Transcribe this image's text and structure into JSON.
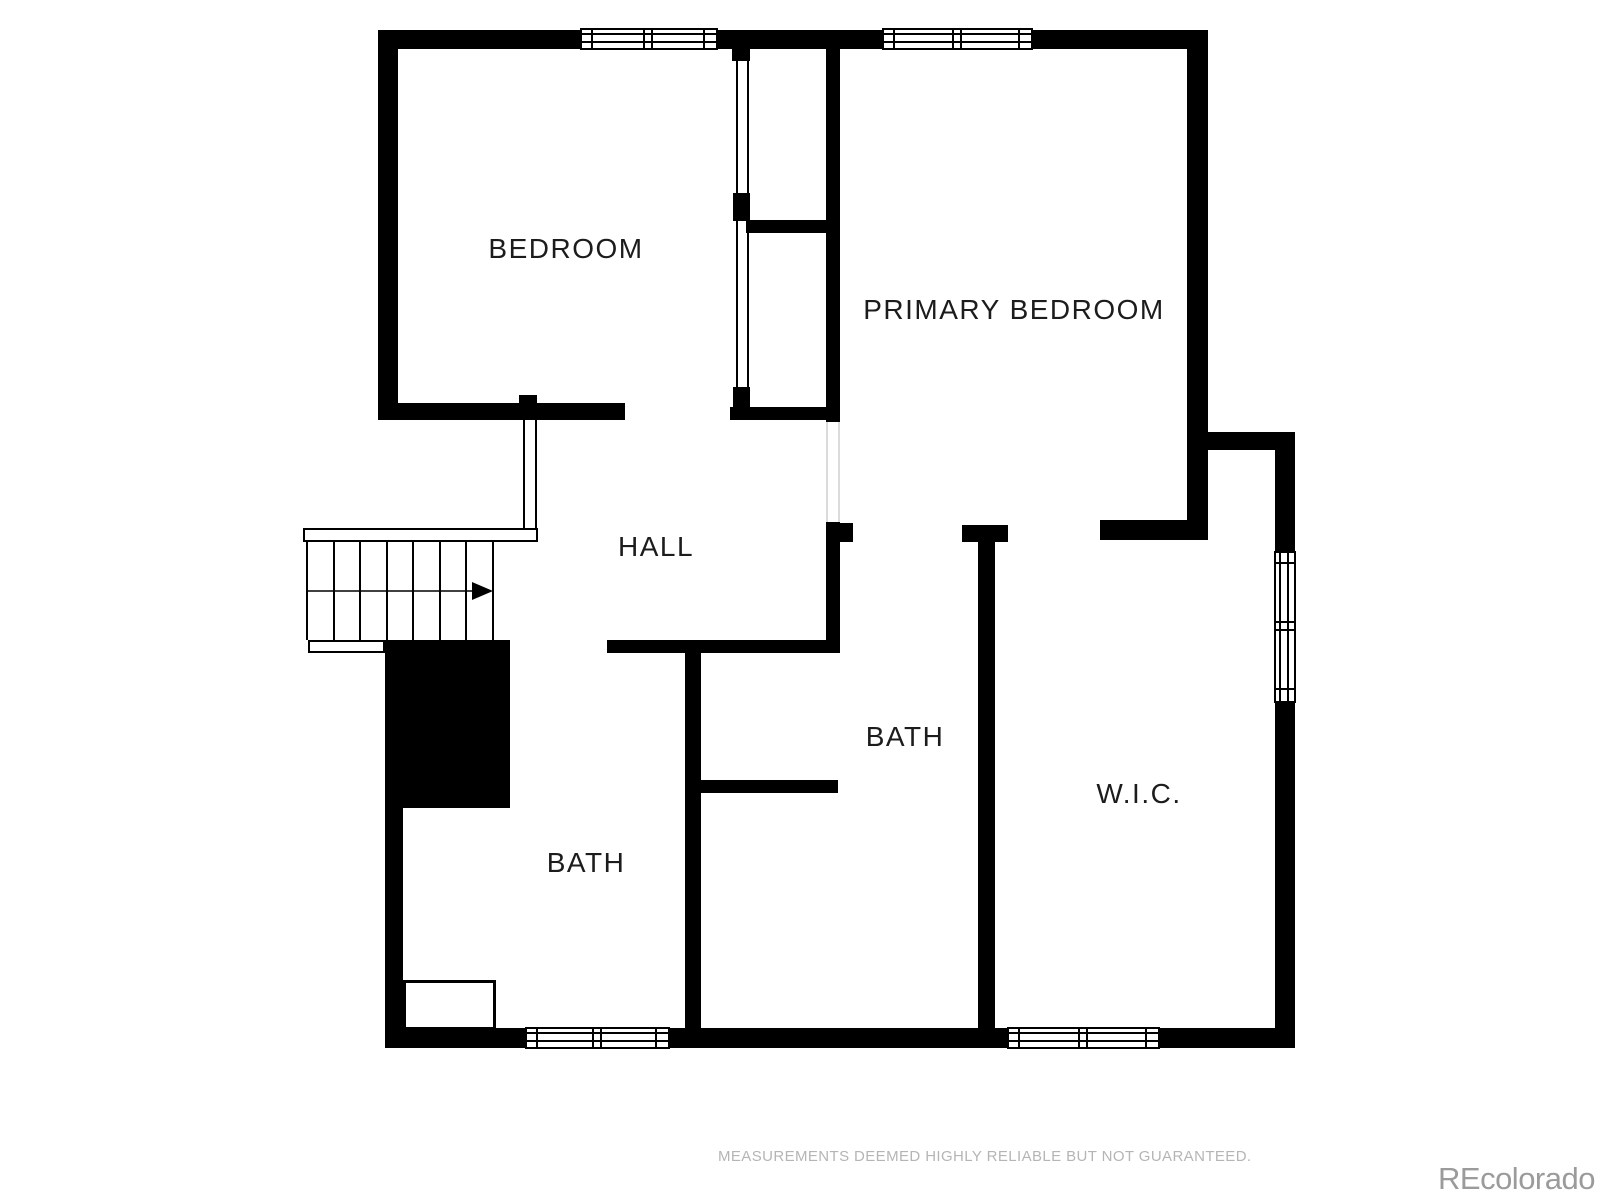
{
  "plan": {
    "type": "floor-plan",
    "rooms": [
      {
        "id": "bedroom",
        "label": "BEDROOM"
      },
      {
        "id": "primary-bedroom",
        "label": "PRIMARY BEDROOM"
      },
      {
        "id": "hall",
        "label": "HALL"
      },
      {
        "id": "bath-middle",
        "label": "BATH"
      },
      {
        "id": "bath-left",
        "label": "BATH"
      },
      {
        "id": "wic",
        "label": "W.I.C."
      }
    ],
    "stairs": {
      "direction": "right"
    }
  },
  "footer": {
    "disclaimer": "MEASUREMENTS DEEMED HIGHLY RELIABLE BUT NOT GUARANTEED.",
    "watermark": "REcolorado"
  },
  "colors": {
    "wall": "#000000",
    "label": "#1c1c1c",
    "muted_text": "#b5b5b5",
    "watermark": "#9b9b9b",
    "door_opening": "#cfcfcf"
  }
}
